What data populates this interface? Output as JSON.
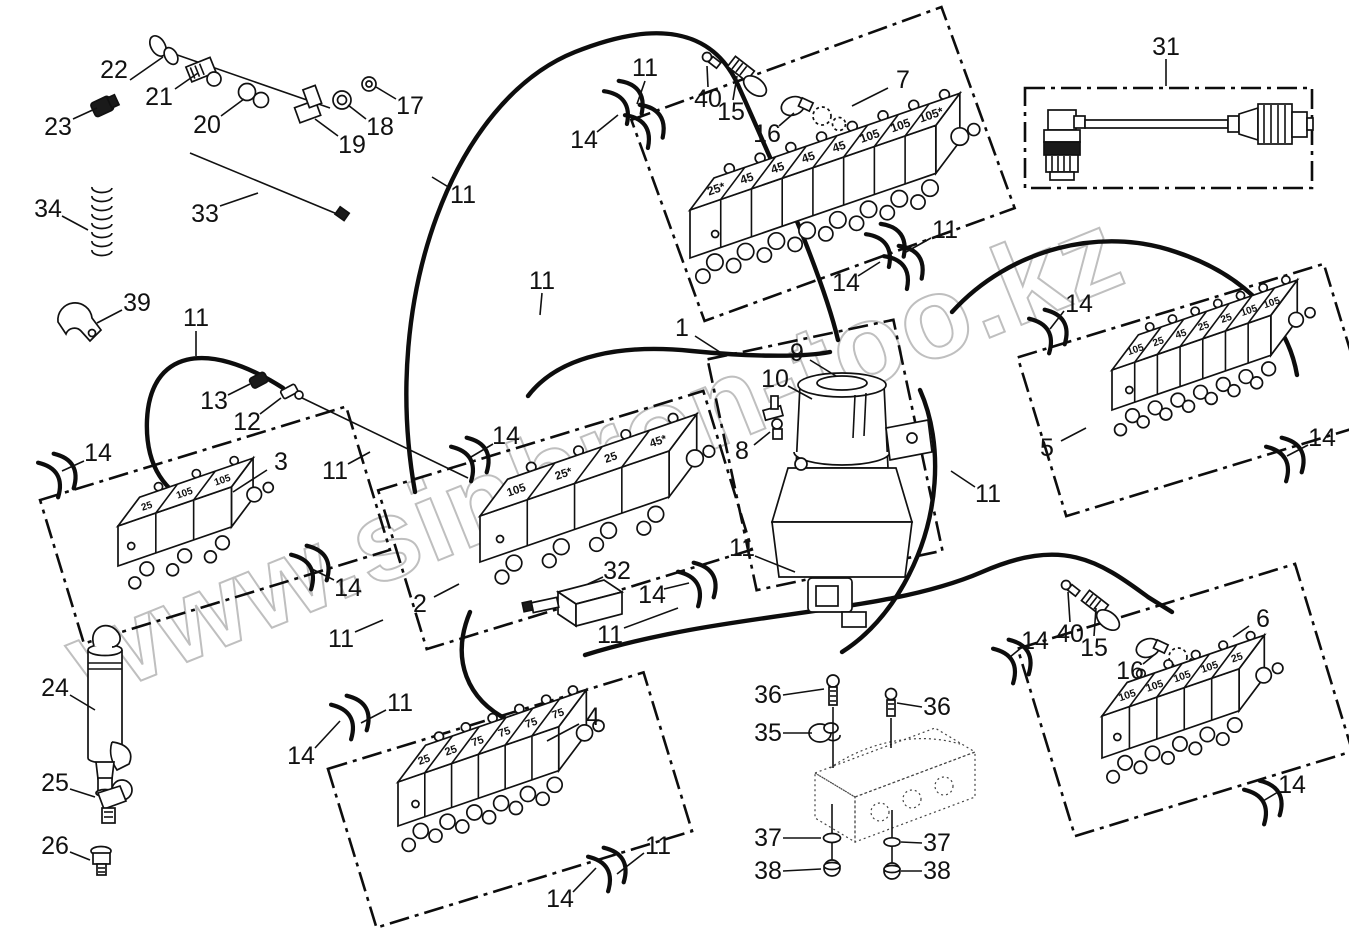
{
  "watermark": "www.sinhron-too.kz",
  "blocks": {
    "b7": {
      "segments": [
        "25*",
        "45",
        "45",
        "45",
        "45",
        "105",
        "105",
        "105*"
      ]
    },
    "b3": {
      "segments": [
        "25",
        "105",
        "105"
      ]
    },
    "b2": {
      "segments": [
        "105",
        "25*",
        "25",
        "45*"
      ]
    },
    "b5": {
      "segments": [
        "105",
        "25",
        "45",
        "25",
        "25",
        "105",
        "105"
      ]
    },
    "b4": {
      "segments": [
        "25",
        "25",
        "75",
        "75",
        "75",
        "75"
      ]
    },
    "b6": {
      "segments": [
        "105",
        "105",
        "105",
        "105",
        "25"
      ]
    }
  },
  "callouts": [
    {
      "label": "22",
      "x": 114,
      "y": 70,
      "leader": [
        130,
        80,
        163,
        57
      ]
    },
    {
      "label": "21",
      "x": 159,
      "y": 97,
      "leader": [
        175,
        89,
        198,
        73
      ]
    },
    {
      "label": "23",
      "x": 58,
      "y": 127,
      "leader": [
        73,
        119,
        97,
        108
      ]
    },
    {
      "label": "20",
      "x": 207,
      "y": 125,
      "leader": [
        221,
        116,
        244,
        99
      ]
    },
    {
      "label": "19",
      "x": 352,
      "y": 145,
      "leader": [
        338,
        136,
        315,
        119
      ]
    },
    {
      "label": "18",
      "x": 380,
      "y": 127,
      "leader": [
        366,
        119,
        348,
        105
      ]
    },
    {
      "label": "17",
      "x": 410,
      "y": 106,
      "leader": [
        396,
        99,
        376,
        87
      ]
    },
    {
      "label": "33",
      "x": 205,
      "y": 214,
      "leader": [
        220,
        206,
        258,
        193
      ]
    },
    {
      "label": "34",
      "x": 48,
      "y": 209,
      "leader": [
        62,
        216,
        88,
        230
      ]
    },
    {
      "label": "39",
      "x": 137,
      "y": 303,
      "leader": [
        122,
        310,
        97,
        323
      ]
    },
    {
      "label": "11",
      "x": 196,
      "y": 318,
      "leader": [
        196,
        331,
        196,
        356
      ]
    },
    {
      "label": "13",
      "x": 214,
      "y": 401,
      "leader": [
        228,
        395,
        250,
        384
      ]
    },
    {
      "label": "12",
      "x": 247,
      "y": 422,
      "leader": [
        260,
        414,
        281,
        398
      ]
    },
    {
      "label": "14",
      "x": 98,
      "y": 453,
      "leader": [
        84,
        461,
        62,
        471
      ]
    },
    {
      "label": "3",
      "x": 281,
      "y": 462,
      "leader": [
        267,
        470,
        233,
        492
      ]
    },
    {
      "label": "11",
      "x": 335,
      "y": 471,
      "leader": [
        348,
        464,
        370,
        452
      ]
    },
    {
      "label": "14",
      "x": 348,
      "y": 588,
      "leader": [
        334,
        580,
        312,
        569
      ]
    },
    {
      "label": "2",
      "x": 420,
      "y": 604,
      "leader": [
        434,
        597,
        459,
        584
      ]
    },
    {
      "label": "11",
      "x": 341,
      "y": 639,
      "leader": [
        355,
        632,
        383,
        620
      ]
    },
    {
      "label": "24",
      "x": 55,
      "y": 688,
      "leader": [
        70,
        695,
        95,
        710
      ]
    },
    {
      "label": "25",
      "x": 55,
      "y": 783,
      "leader": [
        70,
        789,
        95,
        797
      ]
    },
    {
      "label": "26",
      "x": 55,
      "y": 846,
      "leader": [
        70,
        852,
        90,
        860
      ]
    },
    {
      "label": "11",
      "x": 645,
      "y": 68,
      "leader": [
        645,
        81,
        637,
        104
      ]
    },
    {
      "label": "40",
      "x": 708,
      "y": 99,
      "leader": [
        708,
        87,
        707,
        66
      ]
    },
    {
      "label": "15",
      "x": 731,
      "y": 112,
      "leader": [
        733,
        100,
        737,
        76
      ]
    },
    {
      "label": "14",
      "x": 584,
      "y": 140,
      "leader": [
        597,
        132,
        618,
        115
      ]
    },
    {
      "label": "16",
      "x": 767,
      "y": 134,
      "leader": [
        779,
        126,
        794,
        113
      ]
    },
    {
      "label": "7",
      "x": 903,
      "y": 80,
      "leader": [
        888,
        88,
        852,
        106
      ]
    },
    {
      "label": "11",
      "x": 945,
      "y": 230,
      "leader": [
        931,
        238,
        906,
        252
      ]
    },
    {
      "label": "14",
      "x": 846,
      "y": 283,
      "leader": [
        858,
        276,
        880,
        262
      ]
    },
    {
      "label": "31",
      "x": 1166,
      "y": 47,
      "leader": [
        1166,
        59,
        1166,
        86
      ]
    },
    {
      "label": "11",
      "x": 463,
      "y": 195,
      "leader": [
        450,
        188,
        432,
        177
      ]
    },
    {
      "label": "11",
      "x": 542,
      "y": 281,
      "leader": [
        542,
        293,
        540,
        315
      ]
    },
    {
      "label": "1",
      "x": 682,
      "y": 328,
      "leader": [
        695,
        336,
        726,
        356
      ]
    },
    {
      "label": "9",
      "x": 797,
      "y": 353,
      "leader": [
        810,
        360,
        836,
        376
      ]
    },
    {
      "label": "10",
      "x": 775,
      "y": 379,
      "leader": [
        788,
        386,
        812,
        399
      ]
    },
    {
      "label": "8",
      "x": 742,
      "y": 451,
      "leader": [
        754,
        445,
        770,
        432
      ]
    },
    {
      "label": "14",
      "x": 506,
      "y": 436,
      "leader": [
        493,
        444,
        471,
        457
      ]
    },
    {
      "label": "32",
      "x": 617,
      "y": 571,
      "leader": [
        603,
        577,
        588,
        584
      ]
    },
    {
      "label": "14",
      "x": 652,
      "y": 595,
      "leader": [
        664,
        589,
        689,
        583
      ]
    },
    {
      "label": "11",
      "x": 742,
      "y": 548,
      "leader": [
        755,
        556,
        795,
        572
      ]
    },
    {
      "label": "11",
      "x": 610,
      "y": 635,
      "leader": [
        624,
        628,
        678,
        608
      ]
    },
    {
      "label": "11",
      "x": 988,
      "y": 494,
      "leader": [
        975,
        487,
        951,
        471
      ]
    },
    {
      "label": "14",
      "x": 1079,
      "y": 304,
      "leader": [
        1064,
        311,
        1050,
        329
      ]
    },
    {
      "label": "5",
      "x": 1047,
      "y": 448,
      "leader": [
        1061,
        441,
        1086,
        428
      ]
    },
    {
      "label": "14",
      "x": 1322,
      "y": 438,
      "leader": [
        1308,
        445,
        1287,
        456
      ]
    },
    {
      "label": "6",
      "x": 1263,
      "y": 619,
      "leader": [
        1249,
        626,
        1233,
        637
      ]
    },
    {
      "label": "14",
      "x": 1035,
      "y": 641,
      "leader": [
        1021,
        648,
        1010,
        657
      ]
    },
    {
      "label": "40",
      "x": 1070,
      "y": 634,
      "leader": [
        1070,
        622,
        1068,
        592
      ]
    },
    {
      "label": "15",
      "x": 1094,
      "y": 648,
      "leader": [
        1094,
        636,
        1096,
        608
      ]
    },
    {
      "label": "16",
      "x": 1130,
      "y": 671,
      "leader": [
        1143,
        664,
        1154,
        655
      ]
    },
    {
      "label": "14",
      "x": 1292,
      "y": 785,
      "leader": [
        1278,
        792,
        1263,
        801
      ]
    },
    {
      "label": "4",
      "x": 593,
      "y": 717,
      "leader": [
        579,
        724,
        547,
        741
      ]
    },
    {
      "label": "11",
      "x": 400,
      "y": 703,
      "leader": [
        386,
        710,
        361,
        723
      ]
    },
    {
      "label": "14",
      "x": 301,
      "y": 756,
      "leader": [
        315,
        748,
        340,
        721
      ]
    },
    {
      "label": "36",
      "x": 768,
      "y": 695,
      "leader": [
        783,
        695,
        824,
        689
      ]
    },
    {
      "label": "36",
      "x": 937,
      "y": 707,
      "leader": [
        922,
        707,
        897,
        703
      ]
    },
    {
      "label": "35",
      "x": 768,
      "y": 733,
      "leader": [
        783,
        733,
        812,
        733
      ]
    },
    {
      "label": "37",
      "x": 768,
      "y": 838,
      "leader": [
        783,
        838,
        821,
        838
      ]
    },
    {
      "label": "37",
      "x": 937,
      "y": 843,
      "leader": [
        922,
        843,
        901,
        842
      ]
    },
    {
      "label": "38",
      "x": 768,
      "y": 871,
      "leader": [
        783,
        871,
        821,
        869
      ]
    },
    {
      "label": "38",
      "x": 937,
      "y": 871,
      "leader": [
        922,
        871,
        901,
        871
      ]
    },
    {
      "label": "11",
      "x": 658,
      "y": 846,
      "leader": [
        644,
        853,
        617,
        874
      ]
    },
    {
      "label": "14",
      "x": 560,
      "y": 899,
      "leader": [
        573,
        892,
        596,
        868
      ]
    }
  ]
}
